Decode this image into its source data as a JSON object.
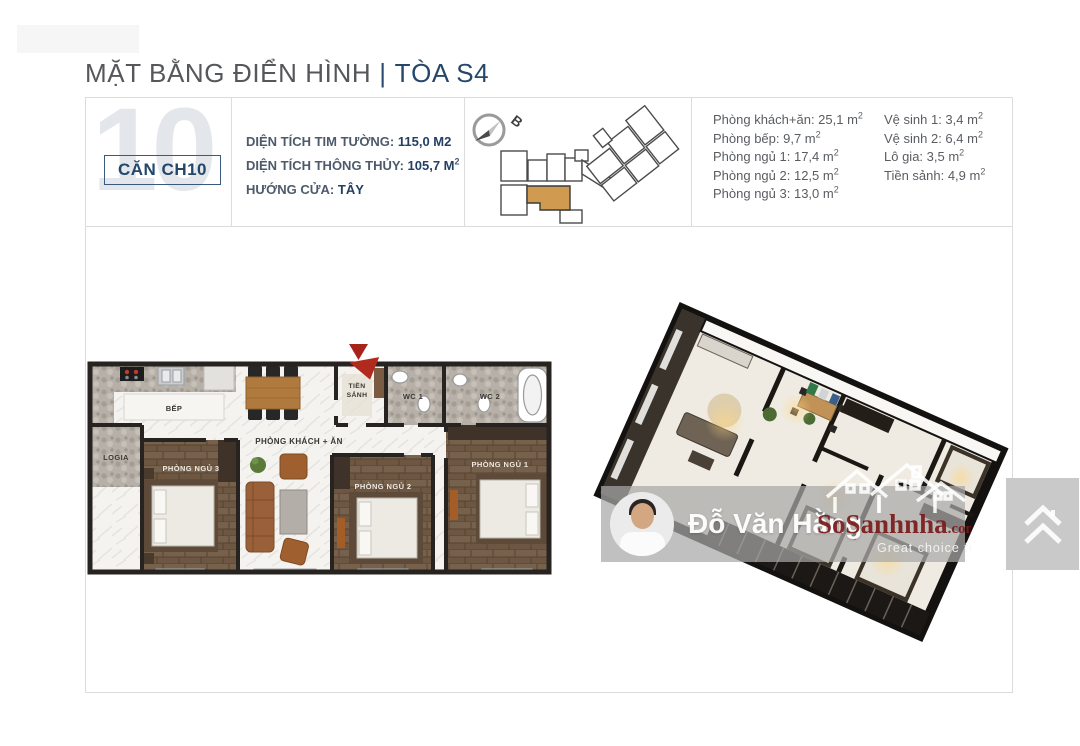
{
  "header": {
    "title_main": "MẶT BẰNG ĐIỂN HÌNH",
    "separator": "|",
    "title_tower": "TÒA S4"
  },
  "unit_card": {
    "background_number": "10",
    "label": "CĂN CH10"
  },
  "specs": [
    {
      "label": "DIỆN TÍCH TIM TƯỜNG: ",
      "value": "115,0 M2",
      "sup": ""
    },
    {
      "label": "DIỆN TÍCH THÔNG THỦY: ",
      "value": "105,7 M",
      "sup": "2"
    },
    {
      "label": "HƯỚNG CỬA: ",
      "value": "TÂY",
      "sup": ""
    }
  ],
  "locator": {
    "compass_label": "B"
  },
  "room_areas": {
    "left": [
      {
        "text": "Phòng khách+ăn: 25,1 m",
        "sup": "2"
      },
      {
        "text": "Phòng bếp: 9,7 m",
        "sup": "2"
      },
      {
        "text": "Phòng ngủ 1: 17,4 m",
        "sup": "2"
      },
      {
        "text": "Phòng ngủ 2: 12,5 m",
        "sup": "2"
      },
      {
        "text": "Phòng ngủ 3: 13,0 m",
        "sup": "2"
      }
    ],
    "right": [
      {
        "text": "Vệ sinh 1: 3,4 m",
        "sup": "2"
      },
      {
        "text": "Vệ sinh 2: 6,4 m",
        "sup": "2"
      },
      {
        "text": "Lô gia: 3,5 m",
        "sup": "2"
      },
      {
        "text": "Tiền sảnh: 4,9 m",
        "sup": "2"
      }
    ]
  },
  "floorplan_2d": {
    "labels": {
      "kitchen": "BẾP",
      "logia": "LOGIA",
      "living": "PHÒNG KHÁCH + ĂN",
      "hall_line1": "TIỀN",
      "hall_line2": "SẢNH",
      "wc1": "WC 1",
      "wc2": "WC 2",
      "bedroom1": "PHÒNG NGỦ 1",
      "bedroom2": "PHÒNG NGỦ 2",
      "bedroom3": "PHÒNG NGỦ 3"
    }
  },
  "watermark": {
    "agent_name": "Đỗ Văn Hằng",
    "logo_name": "SoSanhnha",
    "logo_tld": ".com",
    "tagline": "Great choice for you"
  },
  "colors": {
    "navy": "#25476a",
    "title_gray": "#55575b",
    "accent_orange": "#d09a50",
    "marker_red": "#a8231b",
    "logo_red": "#7d1f1f",
    "border": "#dcdcdc"
  }
}
